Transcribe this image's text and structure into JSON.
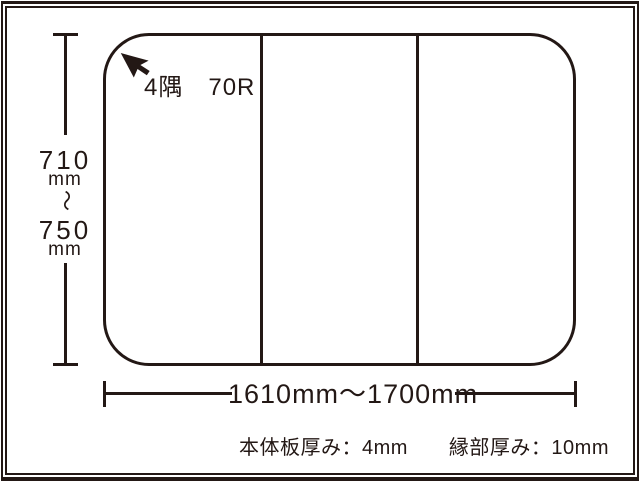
{
  "diagram": {
    "type": "bath-lid-dimension-drawing",
    "colors": {
      "ink": "#231815",
      "background": "#ffffff"
    },
    "lid": {
      "panel_count": 3,
      "corner_note": "4隅　70R"
    },
    "height_dimension": {
      "value_top": "710",
      "unit_top": "mm",
      "range_tilde": "～",
      "value_bottom": "750",
      "unit_bottom": "mm"
    },
    "width_dimension": {
      "label": "1610mm～1700mm"
    },
    "thickness_note": "本体板厚み：4mm　　縁部厚み：10mm"
  }
}
